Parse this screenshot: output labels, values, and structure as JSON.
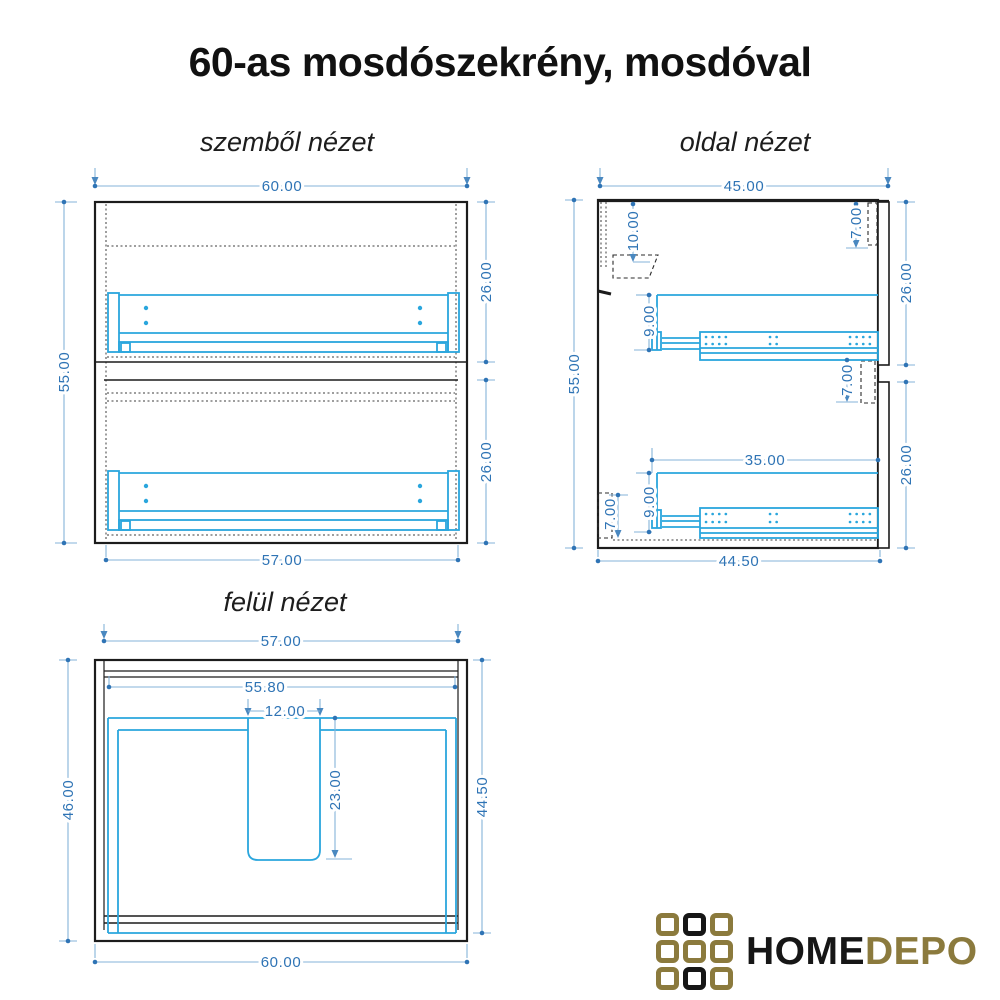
{
  "title": "60-as mosdószekrény, mosdóval",
  "front_view": {
    "label": "szemből nézet",
    "dim_width_top": "60.00",
    "dim_height": "55.00",
    "dim_drawer_upper": "26.00",
    "dim_drawer_lower": "26.00",
    "dim_width_bottom": "57.00"
  },
  "side_view": {
    "label": "oldal nézet",
    "dim_depth_top": "45.00",
    "dim_height": "55.00",
    "dim_bracket_offset": "10.00",
    "dim_front_overlap_top": "7.00",
    "dim_front_upper": "26.00",
    "dim_rail_height_upper": "9.00",
    "dim_gap_middle": "7.00",
    "dim_rail_length": "35.00",
    "dim_rail_height_lower": "9.00",
    "dim_plinth": "7.00",
    "dim_front_lower": "26.00",
    "dim_depth_bottom": "44.50"
  },
  "top_view": {
    "label": "felül nézet",
    "dim_width_top": "57.00",
    "dim_width_inner": "55.80",
    "dim_cutout_width": "12.00",
    "dim_cutout_depth": "23.00",
    "dim_depth_left": "46.00",
    "dim_depth_right": "44.50",
    "dim_width_bottom": "60.00"
  },
  "logo": {
    "text_home": "HOME",
    "text_depo": "DEPO"
  },
  "colors": {
    "outline": "#1c1c1c",
    "hardware_blue": "#2aa6dd",
    "dim_line": "#85b3d9",
    "dim_text": "#2f74b5",
    "logo_gold": "#8b7a3d",
    "logo_black": "#161616",
    "background": "#ffffff"
  }
}
